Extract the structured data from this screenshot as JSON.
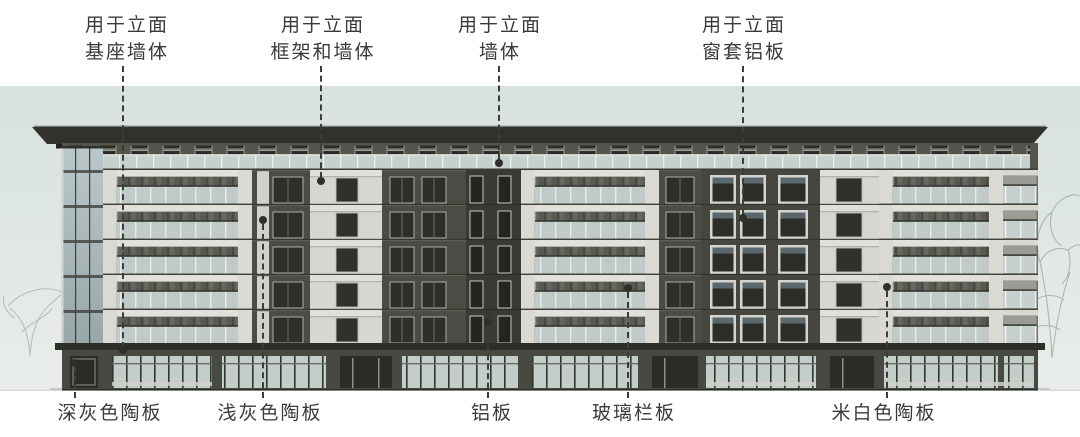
{
  "top_callouts": [
    {
      "line1": "用于立面",
      "line2": "基座墙体"
    },
    {
      "line1": "用于立面",
      "line2": "框架和墙体"
    },
    {
      "line1": "用于立面",
      "line2": "墙体"
    },
    {
      "line1": "用于立面",
      "line2": "窗套铝板"
    }
  ],
  "bottom_callouts": [
    {
      "label": "深灰色陶板"
    },
    {
      "label": "浅灰色陶板"
    },
    {
      "label": "铝板"
    },
    {
      "label": "玻璃栏板"
    },
    {
      "label": "米白色陶板"
    }
  ],
  "colors": {
    "sky": "#d9e2de",
    "roof": "#32322c",
    "dark_wall": "#4b4c45",
    "darkest_wall": "#3b3933",
    "light_panel": "#d9d8d2",
    "railing_glass": "#c8d3d1",
    "base_wall": "#494943",
    "leader_line": "#3c3d38",
    "label_text": "#3a3a3a"
  }
}
